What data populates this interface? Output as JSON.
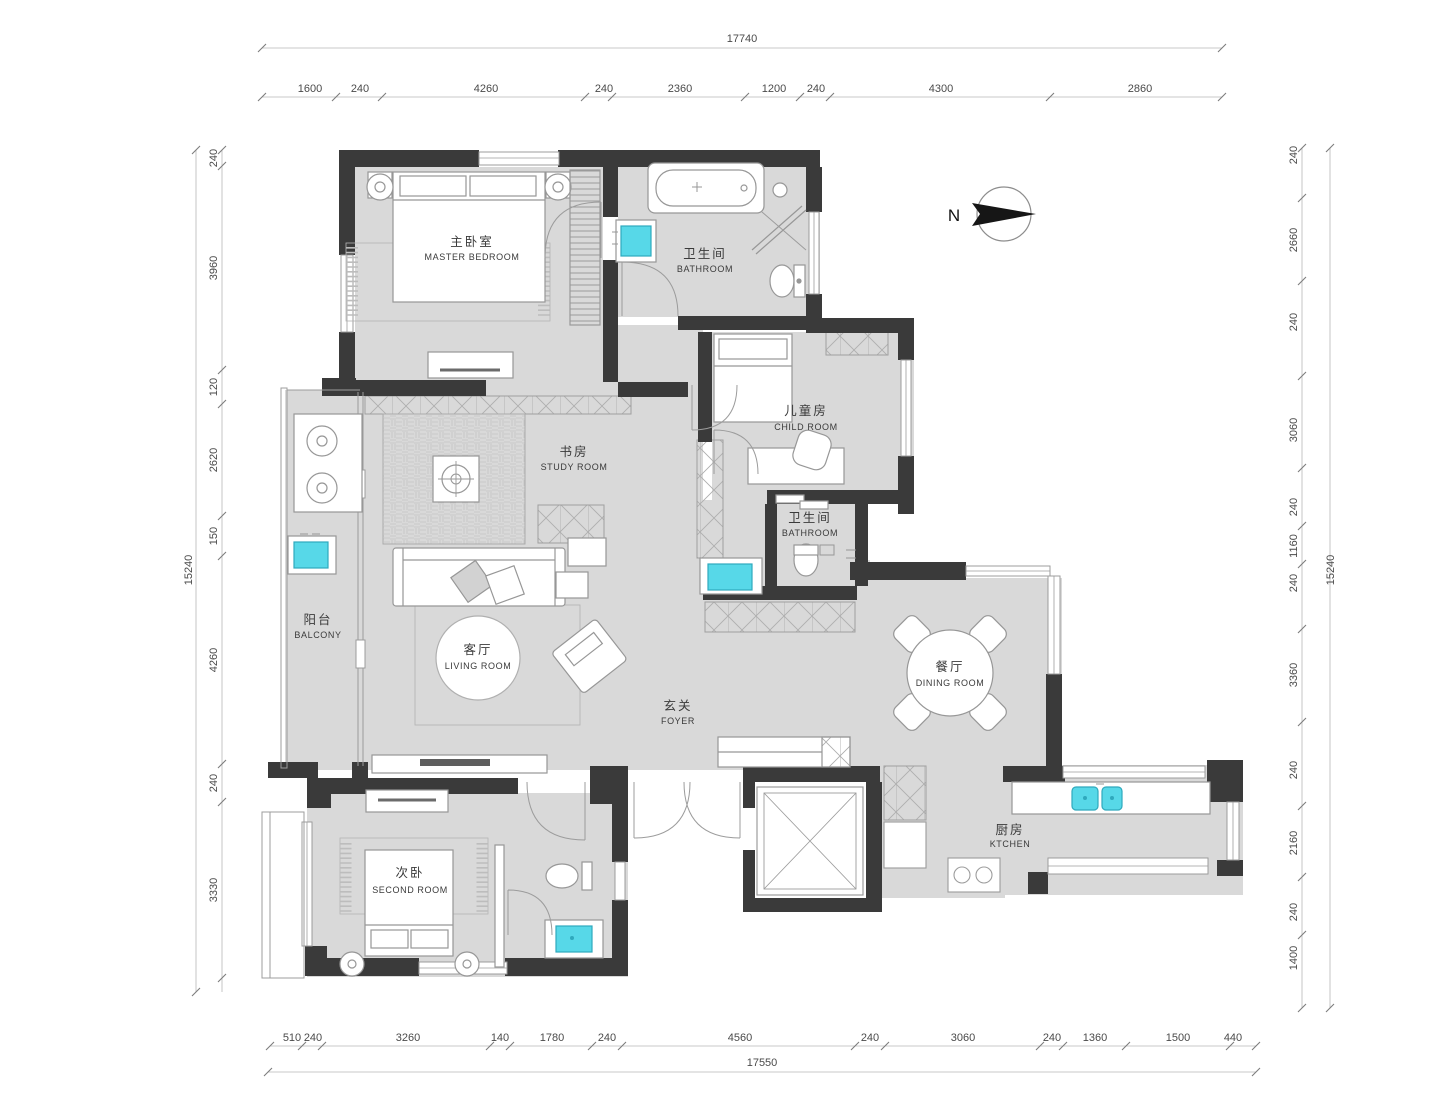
{
  "plan": {
    "type": "residential-floor-plan",
    "compass": {
      "label": "N"
    },
    "colors": {
      "wall": "#3a3a3a",
      "floor": "#d9d9d9",
      "fixture_cyan": "#57d8e8",
      "furniture_stroke": "#979797"
    },
    "rooms": {
      "master_bedroom": {
        "zh": "主卧室",
        "en": "MASTER BEDROOM"
      },
      "bathroom_top": {
        "zh": "卫生间",
        "en": "BATHROOM"
      },
      "child_room": {
        "zh": "儿童房",
        "en": "CHILD ROOM"
      },
      "study_room": {
        "zh": "书房",
        "en": "STUDY ROOM"
      },
      "bathroom_mid": {
        "zh": "卫生间",
        "en": "BATHROOM"
      },
      "balcony": {
        "zh": "阳台",
        "en": "BALCONY"
      },
      "living_room": {
        "zh": "客厅",
        "en": "LIVING ROOM"
      },
      "foyer": {
        "zh": "玄关",
        "en": "FOYER"
      },
      "dining_room": {
        "zh": "餐厅",
        "en": "DINING ROOM"
      },
      "kitchen": {
        "zh": "厨房",
        "en": "KTCHEN"
      },
      "second_room": {
        "zh": "次卧",
        "en": "SECOND ROOM"
      }
    },
    "dims": {
      "top": {
        "total": "17740",
        "segments": [
          "1600",
          "240",
          "4260",
          "240",
          "2360",
          "1200",
          "240",
          "4300",
          "2860"
        ]
      },
      "bottom": {
        "total": "17550",
        "segments": [
          "510",
          "240",
          "3260",
          "140",
          "1780",
          "240",
          "4560",
          "240",
          "3060",
          "240",
          "1360",
          "1500",
          "440"
        ]
      },
      "left": {
        "total": "15240",
        "segments": [
          "240",
          "3960",
          "120",
          "2620",
          "150",
          "4260",
          "240",
          "3330"
        ]
      },
      "right": {
        "total": "15240",
        "segments": [
          "240",
          "2660",
          "240",
          "3060",
          "240",
          "1160",
          "240",
          "3360",
          "240",
          "2160",
          "240",
          "1400"
        ]
      }
    }
  }
}
